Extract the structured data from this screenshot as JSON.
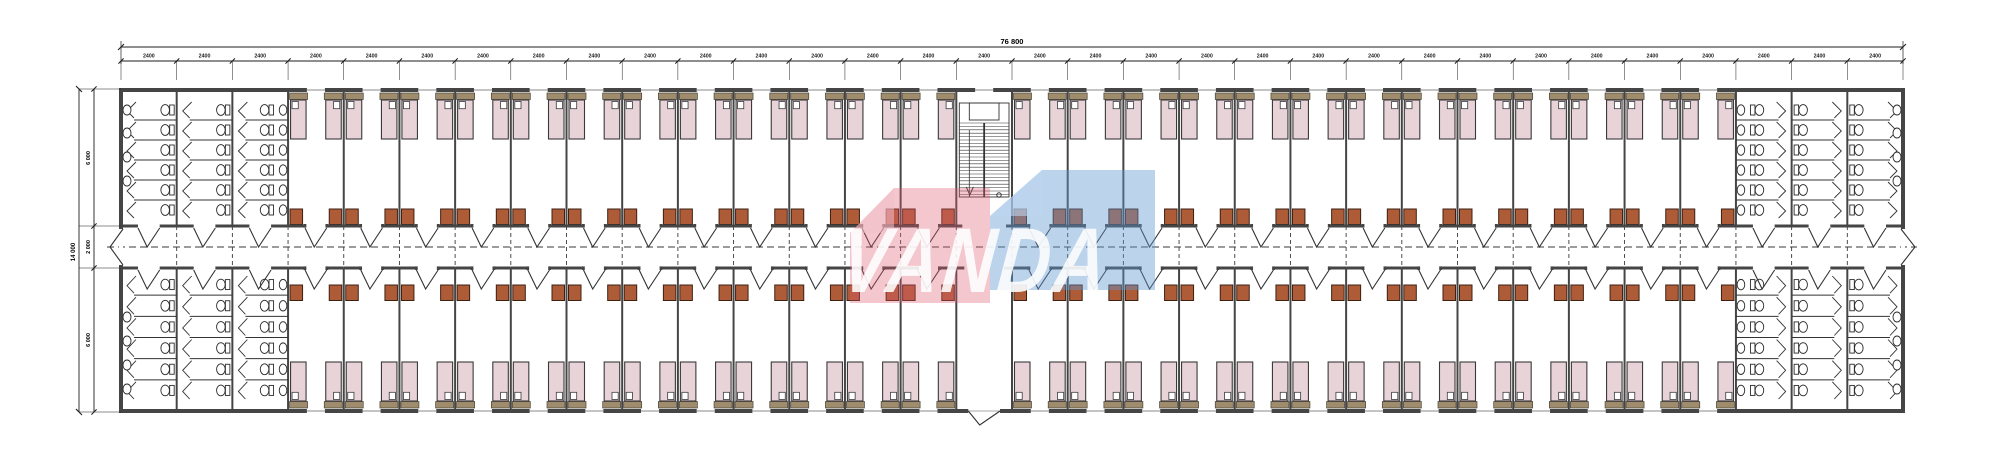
{
  "drawing": {
    "type": "architectural-floor-plan",
    "description": "dormitory block floor plan with double-loaded corridor",
    "watermark": {
      "text": "VANDA"
    },
    "dimensions": {
      "top_total_label": "76 800",
      "bay_label": "2400",
      "bay_count": 32,
      "left_total_label": "14 000",
      "left_segments": [
        "6 000",
        "2 000",
        "6 000"
      ]
    },
    "layout_counts": {
      "room_bays_per_side": 25,
      "beds_per_room": 2,
      "desks_per_room": 2,
      "bathroom_bays_each_end": 3,
      "toilet_stalls_per_column": 6,
      "sinks_on_end_wall": 4,
      "sinks_in_washroom_column": 6,
      "stair_bay_index": 16
    },
    "colors": {
      "wall": "#454545",
      "line": "#333333",
      "dash": "#3a3a3a",
      "bed_fill": "#e8d4d8",
      "bed_stroke": "#3a393b",
      "pillow_fill": "#ffffff",
      "headboard_fill": "#9f8c6d",
      "headboard_stroke": "#4a4438",
      "desk_fill": "#ae5c38",
      "desk_stroke": "#3c2012",
      "fixture_stroke": "#2a2a2a",
      "fixture_fill": "#ffffff",
      "dim_color": "#1d1d1d",
      "watermark_red": "#e05a6e",
      "watermark_red_light": "#f3bfca",
      "watermark_blue": "#5f97d2",
      "watermark_blue_light": "#bcd6ee",
      "watermark_text": "#ffffff"
    }
  }
}
